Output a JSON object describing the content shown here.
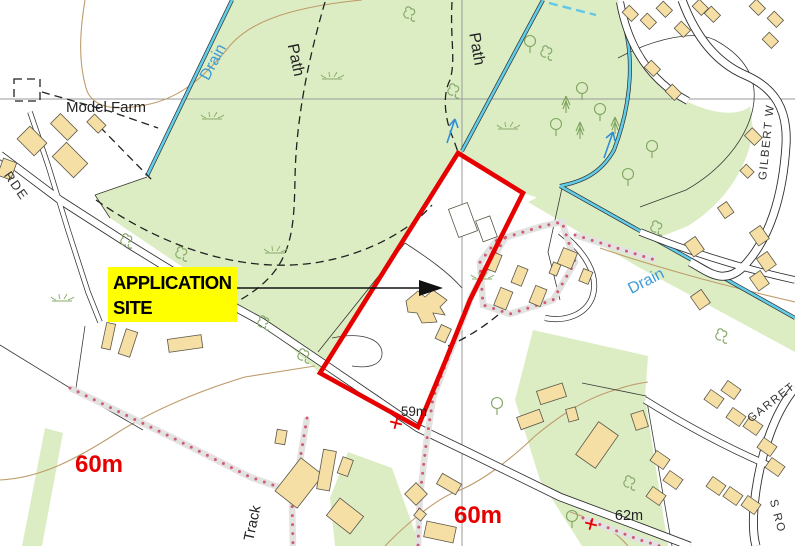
{
  "map": {
    "place_labels": {
      "model_farm": "Model Farm",
      "drain_top": "Drain",
      "drain_right": "Drain",
      "path_left": "Path",
      "path_right": "Path",
      "track": "Track"
    },
    "road_labels": {
      "left_fragment": "RDE",
      "gilbert": "GILBERT W",
      "garret": "GARRET",
      "garrets_cont": "S RO"
    },
    "spot_heights": {
      "west_60m": "60m",
      "south_60m": "60m",
      "h59": "59m",
      "h62": "62m"
    },
    "annotation": {
      "line1": "APPLICATION",
      "line2": "SITE",
      "highlight": "#ffff00",
      "boundary_color": "#e60000"
    },
    "colors": {
      "woodland": "#dcedc4",
      "building_fill": "#f6dfa5",
      "building_stroke": "#5a5648",
      "drain": "#62cde8",
      "drain_label_blue": "#3d9bd8",
      "contour_brown": "#bf9c6b",
      "footpath_dot": "#d05c74",
      "grid_grey": "#999999",
      "spot_height_red": "#e60000",
      "highlight_yellow": "#ffff00"
    }
  }
}
